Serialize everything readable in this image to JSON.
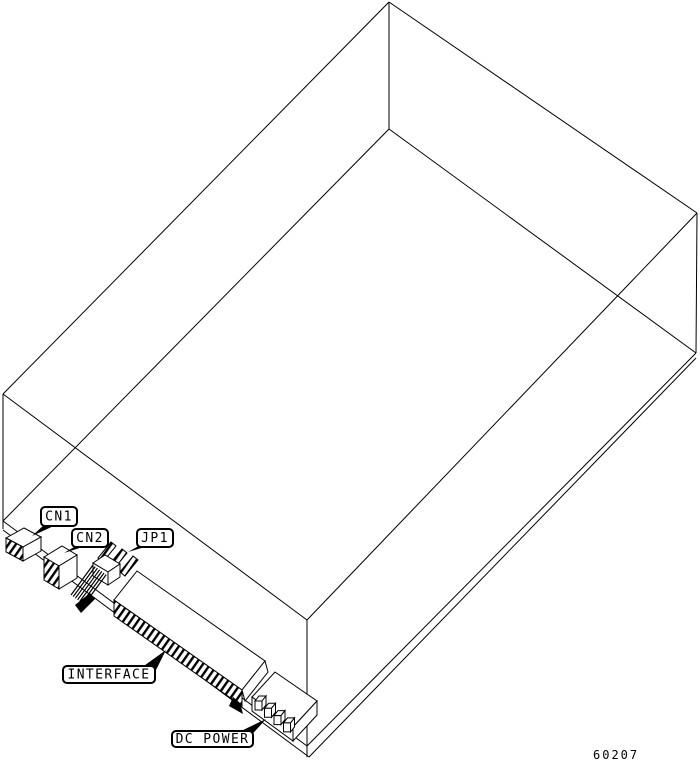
{
  "callouts": {
    "cn1": "CN1",
    "cn2": "CN2",
    "jp1": "JP1",
    "interface": "INTERFACE",
    "dc_power": "DC POWER"
  },
  "part_number": "60207",
  "colors": {
    "line": "#000000",
    "background": "#ffffff"
  }
}
